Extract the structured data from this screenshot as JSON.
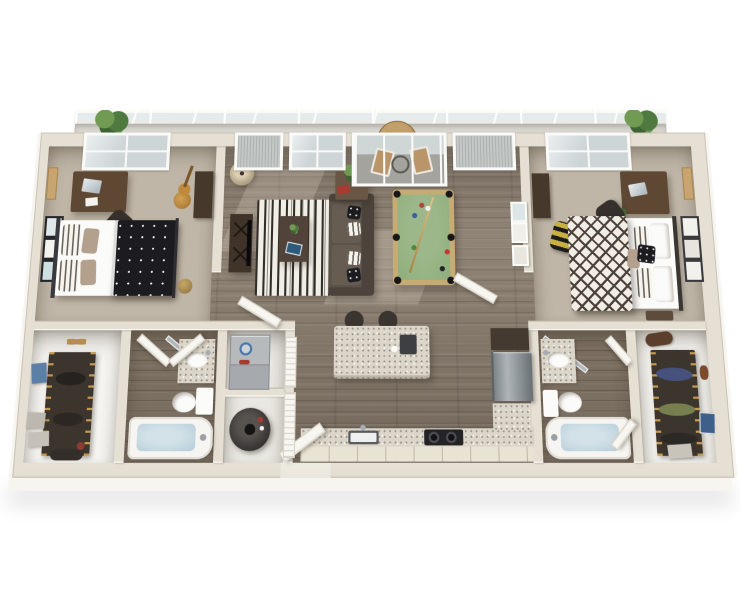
{
  "scene": {
    "description": "Photorealistic 3D top-down render of a two-bedroom two-bathroom apartment floor plan with a balcony, no visible text labels",
    "view": "isometric top-down, slight perspective, white background"
  },
  "colors": {
    "background": "#ffffff",
    "wallTop": "#e6e0d4",
    "wallFace": "#f7f5f0",
    "wallEdge": "#cdc5b4",
    "carpet": "#bfb6a7",
    "sun": "#f2e9d7",
    "wood": "#8a7e6f",
    "bathFloor": "#7b6f61",
    "closetFloor": "#f5f4f0",
    "utilFloor": "#eae8e2",
    "balconyFloor": "#d8d5cf",
    "glass": "#cdd5d7",
    "mesh": "#c4c9c7",
    "frameWhite": "#fafaf8",
    "doorWhite": "#f8f6f1",
    "poolFelt": "#8fad7c",
    "poolRail": "#c6ab74",
    "sofa": "#5b5249",
    "sofaDark": "#4c443c",
    "rugBase": "#f1eee6",
    "rugStripe": "#322d28",
    "duvetBlack": "#1b1b20",
    "duvetCream": "#f2eee5",
    "duvetLattice": "#4a4138",
    "accentPillow": "#b3a08d",
    "darkWood": "#46392c",
    "deskWood": "#5e4833",
    "granite": "#dbd6c9",
    "steelLight": "#aeb4b7",
    "steelDark": "#6d7478",
    "appliance": "#b7babd",
    "water": "#b6cdd9",
    "tub": "#f6f5f2",
    "plant": "#4e7a40",
    "plantLight": "#719b52",
    "tan": "#b8935c",
    "duffel": "#c8b041",
    "navy": "#46517d",
    "olive": "#777f4f",
    "leather": "#5b3f2c",
    "binBlue": "#5b7fa6",
    "accentRed": "#a83a30",
    "chairDark": "#35302b",
    "black": "#17171a"
  },
  "rooms": [
    {
      "name": "bedroom-1",
      "furniture": [
        "bed with black polka-dot duvet",
        "striped pillows",
        "desk",
        "laptop",
        "desk chair",
        "tall dresser",
        "guitar",
        "corkboard",
        "three wall art frames",
        "ball",
        "window",
        "sunlight patch"
      ]
    },
    {
      "name": "living-room",
      "furniture": [
        "dark sofa with pillows",
        "striped fringe rug",
        "coffee table",
        "plant",
        "tablet",
        "tv console",
        "floor lamp",
        "side table with plant and red book",
        "pool table with cue and balls",
        "wall art frames",
        "sliding glass door",
        "windows"
      ]
    },
    {
      "name": "kitchen",
      "furniture": [
        "granite island",
        "two bar stools",
        "coffee maker",
        "granite counter",
        "sink",
        "two-burner cooktop",
        "upper cabinet",
        "stainless refrigerator",
        "entry door"
      ]
    },
    {
      "name": "bedroom-2",
      "furniture": [
        "bed with diamond-lattice duvet",
        "black accent pillow",
        "striped pillows",
        "desk",
        "laptop",
        "desk chair",
        "dresser",
        "corkboard",
        "three wall art frames",
        "yellow-black duffel",
        "plant",
        "window",
        "sunlight patch"
      ]
    },
    {
      "name": "bathroom-1",
      "furniture": [
        "bathtub with water",
        "toilet",
        "granite vanity with sink",
        "double doors",
        "shower glass"
      ]
    },
    {
      "name": "bathroom-2",
      "furniture": [
        "bathtub with water",
        "toilet",
        "granite vanity with sink",
        "double doors",
        "shower glass"
      ]
    },
    {
      "name": "walk-in-closet-1",
      "furniture": [
        "hanging clothes rod",
        "gold hangers",
        "shoes",
        "blue bin",
        "storage boxes",
        "duffel bag"
      ]
    },
    {
      "name": "walk-in-closet-2",
      "furniture": [
        "hanging clothes rod",
        "gold hangers",
        "navy garment",
        "olive garment",
        "leather bag",
        "mask",
        "blue art",
        "box"
      ]
    },
    {
      "name": "utility-closet",
      "furniture": [
        "stacked washer dryer with blue dial",
        "water heater",
        "louvered doors"
      ]
    },
    {
      "name": "balcony",
      "furniture": [
        "glass railing",
        "round wood table",
        "potted plants",
        "two chairs"
      ]
    }
  ]
}
